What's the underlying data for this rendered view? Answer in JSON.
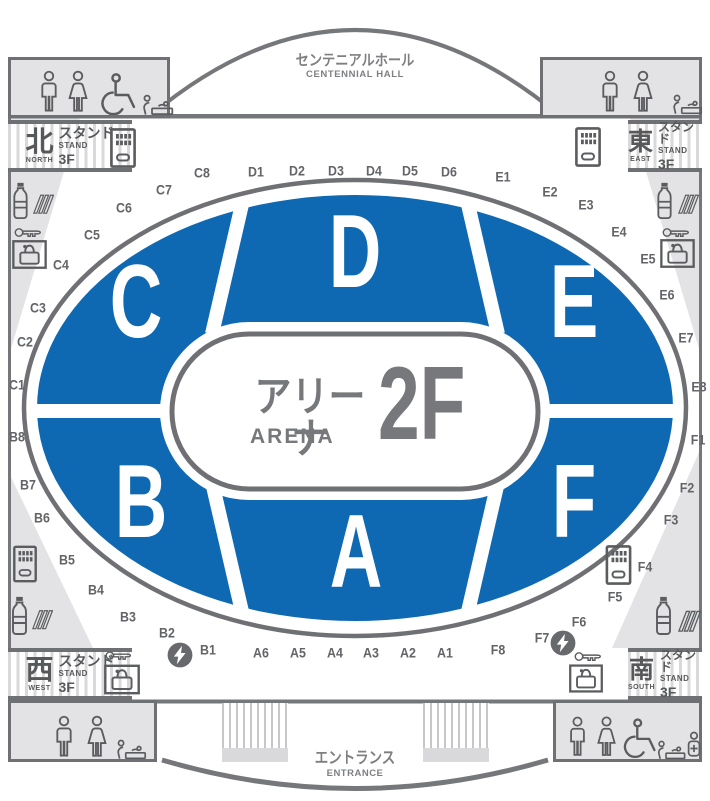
{
  "hall": {
    "title_jp": "センテニアルホール",
    "title_en": "CENTENNIAL HALL"
  },
  "entrance": {
    "title_jp": "エントランス",
    "title_en": "ENTRANCE"
  },
  "arena": {
    "name_jp": "アリーナ",
    "name_en": "ARENA",
    "floor": "2F"
  },
  "colors": {
    "section_blue": "#0e69b2",
    "line_gray": "#76777a",
    "dark_gray": "#5b5c5f",
    "light_gray": "#e3e3e5",
    "label_gray": "#636468",
    "text_gray": "#77787b"
  },
  "stands": [
    {
      "id": "north",
      "kanji": "北",
      "direction": "NORTH",
      "label_jp": "スタンド",
      "label_en": "STAND",
      "floor": "3F"
    },
    {
      "id": "east",
      "kanji": "東",
      "direction": "EAST",
      "label_jp": "スタンド",
      "label_en": "STAND",
      "floor": "3F"
    },
    {
      "id": "west",
      "kanji": "西",
      "direction": "WEST",
      "label_jp": "スタンド",
      "label_en": "STAND",
      "floor": "3F"
    },
    {
      "id": "south",
      "kanji": "南",
      "direction": "SOUTH",
      "label_jp": "スタンド",
      "label_en": "STAND",
      "floor": "3F"
    }
  ],
  "map": {
    "floor_label": "2F",
    "sections": [
      {
        "letter": "C",
        "x": 136,
        "y": 306
      },
      {
        "letter": "D",
        "x": 355,
        "y": 256
      },
      {
        "letter": "E",
        "x": 574,
        "y": 306
      },
      {
        "letter": "B",
        "x": 141,
        "y": 506
      },
      {
        "letter": "A",
        "x": 356,
        "y": 556
      },
      {
        "letter": "F",
        "x": 574,
        "y": 506
      }
    ],
    "gates": [
      {
        "label": "C1",
        "x": 17,
        "y": 385
      },
      {
        "label": "C2",
        "x": 25,
        "y": 342
      },
      {
        "label": "C3",
        "x": 38,
        "y": 308
      },
      {
        "label": "C4",
        "x": 61,
        "y": 265
      },
      {
        "label": "C5",
        "x": 92,
        "y": 235
      },
      {
        "label": "C6",
        "x": 124,
        "y": 208
      },
      {
        "label": "C7",
        "x": 164,
        "y": 190
      },
      {
        "label": "C8",
        "x": 202,
        "y": 173
      },
      {
        "label": "D1",
        "x": 256,
        "y": 172
      },
      {
        "label": "D2",
        "x": 297,
        "y": 171
      },
      {
        "label": "D3",
        "x": 336,
        "y": 171
      },
      {
        "label": "D4",
        "x": 374,
        "y": 171
      },
      {
        "label": "D5",
        "x": 410,
        "y": 171
      },
      {
        "label": "D6",
        "x": 449,
        "y": 172
      },
      {
        "label": "E1",
        "x": 503,
        "y": 177
      },
      {
        "label": "E2",
        "x": 550,
        "y": 192
      },
      {
        "label": "E3",
        "x": 586,
        "y": 205
      },
      {
        "label": "E4",
        "x": 619,
        "y": 232
      },
      {
        "label": "E5",
        "x": 648,
        "y": 259
      },
      {
        "label": "E6",
        "x": 667,
        "y": 295
      },
      {
        "label": "E7",
        "x": 686,
        "y": 338
      },
      {
        "label": "E8",
        "x": 699,
        "y": 387
      },
      {
        "label": "F1",
        "x": 698,
        "y": 440
      },
      {
        "label": "F2",
        "x": 687,
        "y": 488
      },
      {
        "label": "F3",
        "x": 671,
        "y": 520
      },
      {
        "label": "F4",
        "x": 645,
        "y": 567
      },
      {
        "label": "F5",
        "x": 615,
        "y": 597
      },
      {
        "label": "F6",
        "x": 579,
        "y": 622
      },
      {
        "label": "F7",
        "x": 542,
        "y": 638
      },
      {
        "label": "F8",
        "x": 498,
        "y": 650
      },
      {
        "label": "A1",
        "x": 445,
        "y": 653
      },
      {
        "label": "A2",
        "x": 408,
        "y": 653
      },
      {
        "label": "A3",
        "x": 371,
        "y": 653
      },
      {
        "label": "A4",
        "x": 335,
        "y": 653
      },
      {
        "label": "A5",
        "x": 298,
        "y": 653
      },
      {
        "label": "A6",
        "x": 261,
        "y": 653
      },
      {
        "label": "B1",
        "x": 208,
        "y": 650
      },
      {
        "label": "B2",
        "x": 167,
        "y": 633
      },
      {
        "label": "B3",
        "x": 128,
        "y": 617
      },
      {
        "label": "B4",
        "x": 96,
        "y": 590
      },
      {
        "label": "B5",
        "x": 67,
        "y": 560
      },
      {
        "label": "B6",
        "x": 42,
        "y": 518
      },
      {
        "label": "B7",
        "x": 28,
        "y": 485
      },
      {
        "label": "B8",
        "x": 17,
        "y": 437
      }
    ]
  },
  "facilities": {
    "restrooms": {
      "top_left": [
        "mens-toilet",
        "womens-toilet",
        "wheelchair-access",
        "baby-changing"
      ],
      "top_right": [
        "mens-toilet",
        "womens-toilet",
        "baby-changing"
      ],
      "bottom_left": [
        "mens-toilet",
        "womens-toilet",
        "baby-changing"
      ],
      "bottom_right": [
        "mens-toilet",
        "womens-toilet",
        "wheelchair-access",
        "baby-changing",
        "first-aid"
      ]
    },
    "corridors": {
      "top_left": [
        "vending-machine",
        "drink-bottle",
        "stairs",
        "locker-key",
        "coin-locker"
      ],
      "top_right": [
        "vending-machine",
        "drink-bottle",
        "stairs",
        "locker-key",
        "coin-locker"
      ],
      "bottom_left": [
        "vending-machine",
        "drink-bottle",
        "stairs",
        "power",
        "locker-key",
        "coin-locker"
      ],
      "bottom_right": [
        "vending-machine",
        "drink-bottle",
        "stairs",
        "power",
        "locker-key",
        "coin-locker"
      ]
    }
  }
}
